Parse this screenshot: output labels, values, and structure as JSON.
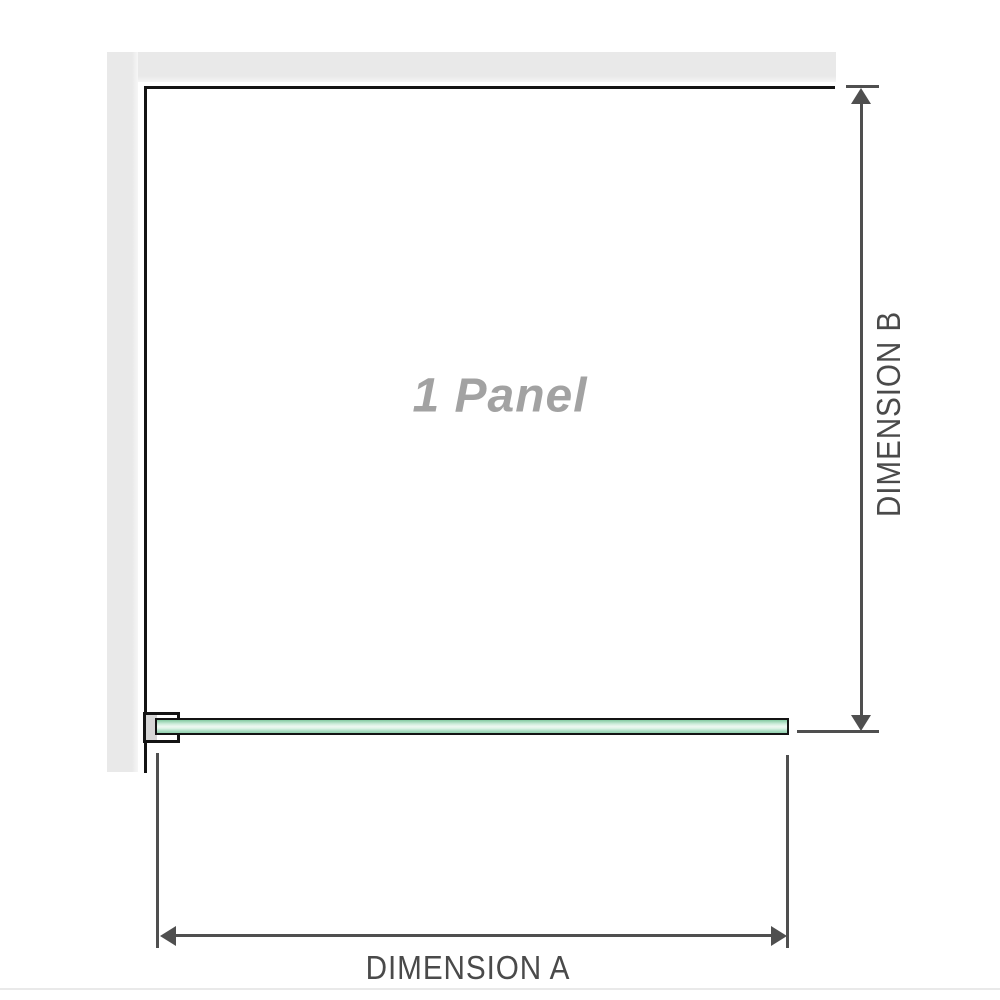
{
  "diagram": {
    "panel_label": "1 Panel",
    "dim_a_label": "DIMENSION A",
    "dim_b_label": "DIMENSION B"
  },
  "colors": {
    "wall_fill": "#e9e9e9",
    "wall_edge": "#141414",
    "dimension_line": "#4f4f4f",
    "dimension_text": "#4a4a4a",
    "panel_text": "#a2a2a2",
    "glass_green_top": "#82c9a1",
    "glass_green_light": "#eef8f2",
    "glass_green_bottom": "#93d1ae",
    "clamp_insert": "#d6d6d6",
    "bottom_rule": "#e9e9e9"
  }
}
